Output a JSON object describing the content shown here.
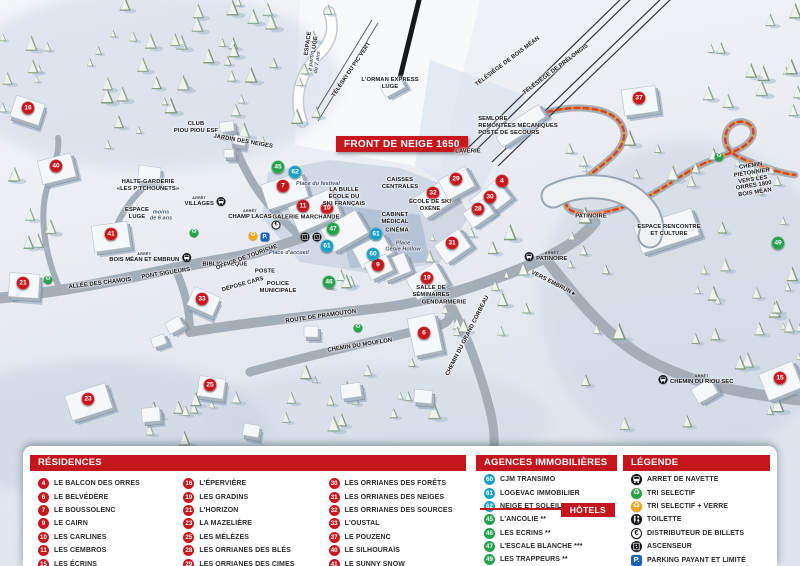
{
  "map": {
    "front_banner": "FRONT DE NEIGE 1650",
    "bus_stop_prefix": "ARRÊT",
    "markers": [
      [
        16,
        28,
        108,
        "residence"
      ],
      [
        40,
        56,
        166,
        "residence"
      ],
      [
        41,
        111,
        234,
        "residence"
      ],
      [
        21,
        23,
        283,
        "residence"
      ],
      [
        33,
        202,
        299,
        "residence"
      ],
      [
        23,
        88,
        399,
        "residence"
      ],
      [
        25,
        210,
        385,
        "residence"
      ],
      [
        7,
        283,
        186,
        "residence"
      ],
      [
        11,
        303,
        206,
        "residence"
      ],
      [
        10,
        327,
        208,
        "residence"
      ],
      [
        9,
        378,
        265,
        "residence"
      ],
      [
        32,
        433,
        193,
        "residence"
      ],
      [
        29,
        456,
        179,
        "residence"
      ],
      [
        4,
        502,
        181,
        "residence"
      ],
      [
        30,
        490,
        197,
        "residence"
      ],
      [
        28,
        478,
        209,
        "residence"
      ],
      [
        31,
        452,
        243,
        "residence"
      ],
      [
        19,
        427,
        278,
        "residence"
      ],
      [
        6,
        424,
        333,
        "residence"
      ],
      [
        37,
        639,
        98,
        "residence"
      ],
      [
        15,
        780,
        378,
        "residence"
      ],
      [
        45,
        278,
        167,
        "hotel"
      ],
      [
        47,
        333,
        229,
        "hotel"
      ],
      [
        46,
        329,
        282,
        "hotel"
      ],
      [
        49,
        778,
        243,
        "hotel"
      ],
      [
        62,
        295,
        172,
        "agency"
      ],
      [
        61,
        327,
        246,
        "agency"
      ],
      [
        61,
        376,
        234,
        "agency"
      ],
      [
        60,
        373,
        254,
        "agency"
      ]
    ],
    "labels": [
      {
        "t": "CLUB\nPIOU PIOU ESF",
        "x": 196,
        "y": 128
      },
      {
        "t": "JARDIN DES NEIGES",
        "x": 243,
        "y": 142,
        "r": 10
      },
      {
        "t": "ESPACE\nLUGE",
        "x": 312,
        "y": 44,
        "r": -82
      },
      {
        "t": "à partir\nde 7 ans",
        "x": 315,
        "y": 62,
        "r": -82,
        "c": "it"
      },
      {
        "t": "TÉLÉSKI DU PIC VERT",
        "x": 352,
        "y": 70,
        "r": -56
      },
      {
        "t": "L'ORMAN EXPRESS\nLUGE",
        "x": 390,
        "y": 84
      },
      {
        "t": "TÉLÉSIÈGE DE BOIS MÉAN",
        "x": 508,
        "y": 62,
        "r": -37
      },
      {
        "t": "TÉLÉSIÈGE DE PRÉLONGIS",
        "x": 556,
        "y": 70,
        "r": -37
      },
      {
        "t": "SEMLORE\nREMONTÉES MÉCANIQUES\nPOSTE DE SECOURS",
        "x": 518,
        "y": 126,
        "c": "lf"
      },
      {
        "t": "HALTE-GARDERIE\n«LES P'TCHOUNETS»",
        "x": 148,
        "y": 186
      },
      {
        "t": "ESPACE\nLUGE",
        "x": 137,
        "y": 214
      },
      {
        "t": "moins\nde 6 ans",
        "x": 161,
        "y": 216,
        "c": "it"
      },
      {
        "t": "Place du festival",
        "x": 318,
        "y": 184,
        "c": "it"
      },
      {
        "t": "LA BULLE\nÉCOLE DU\nSKI FRANÇAIS",
        "x": 344,
        "y": 197
      },
      {
        "t": "GALERIE MARCHANDE",
        "x": 306,
        "y": 218
      },
      {
        "t": "CAISSES\nCENTRALES",
        "x": 400,
        "y": 184
      },
      {
        "t": "ÉCOLE DE SKI\nOXÈNE",
        "x": 430,
        "y": 206
      },
      {
        "t": "CABINET\nMÉDICAL",
        "x": 395,
        "y": 219
      },
      {
        "t": "CINÉMA",
        "x": 397,
        "y": 231
      },
      {
        "t": "Place\nGénie Hollow",
        "x": 403,
        "y": 247,
        "c": "it"
      },
      {
        "t": "LAVERIE",
        "x": 468,
        "y": 152
      },
      {
        "t": "PATINOIRE",
        "x": 591,
        "y": 217
      },
      {
        "t": "ESPACE RENCONTRE\nET CULTURE",
        "x": 669,
        "y": 231
      },
      {
        "t": "CHEMIN PIÉTONNIER\nVERS LES ORRES 1800\nBOIS MÉAN",
        "x": 753,
        "y": 180,
        "r": -9
      },
      {
        "t": "PONT SIGUEURS",
        "x": 166,
        "y": 274,
        "r": -9
      },
      {
        "t": "ALLÉE DES CHAMOIS",
        "x": 100,
        "y": 284,
        "r": -7
      },
      {
        "t": "BIBLIOTHÈQUE",
        "x": 225,
        "y": 265
      },
      {
        "t": "OFFICE DE TOURISME",
        "x": 247,
        "y": 258,
        "r": -20
      },
      {
        "t": "POSTE",
        "x": 265,
        "y": 272
      },
      {
        "t": "DÉPOSE CARS",
        "x": 243,
        "y": 285,
        "r": -16
      },
      {
        "t": "POLICE\nMUNICIPALE",
        "x": 278,
        "y": 288
      },
      {
        "t": "Place d'accueil",
        "x": 289,
        "y": 253,
        "c": "it"
      },
      {
        "t": "ROUTE DE PRAMOUTON",
        "x": 321,
        "y": 317,
        "r": -8
      },
      {
        "t": "CHEMIN DU MOUFLON",
        "x": 360,
        "y": 346,
        "r": -9
      },
      {
        "t": "CHEMIN DU GRAND CORBEAU",
        "x": 468,
        "y": 336,
        "r": -63
      },
      {
        "t": "VERS EMBRUN ▸",
        "x": 553,
        "y": 284,
        "r": 27
      },
      {
        "t": "SALLE DE\nSÉMINAIRES",
        "x": 431,
        "y": 292
      },
      {
        "t": "GENDARMERIE",
        "x": 444,
        "y": 303
      }
    ],
    "bus_stops": [
      {
        "label": "VILLAGES",
        "x": 205,
        "y": 202,
        "icon": "right"
      },
      {
        "label": "CHAMP LACAS",
        "x": 250,
        "y": 215,
        "icon": "none"
      },
      {
        "label": "BOIS MÉAN ET EMBRUN",
        "x": 150,
        "y": 258,
        "icon": "right"
      },
      {
        "label": "PATINOIRE",
        "x": 546,
        "y": 257,
        "icon": "left"
      },
      {
        "label": "CHEMIN DU RIOU SEC",
        "x": 696,
        "y": 380,
        "icon": "left"
      }
    ],
    "icons": [
      {
        "type": "recycle-green",
        "x": 194,
        "y": 233
      },
      {
        "type": "recycle-green",
        "x": 48,
        "y": 280
      },
      {
        "type": "recycle-green",
        "x": 358,
        "y": 328
      },
      {
        "type": "recycle-green",
        "x": 719,
        "y": 157
      },
      {
        "type": "recycle-orange",
        "x": 253,
        "y": 236
      },
      {
        "type": "parking",
        "x": 265,
        "y": 237
      },
      {
        "type": "euro",
        "x": 276,
        "y": 225
      },
      {
        "type": "elevator",
        "x": 305,
        "y": 237
      },
      {
        "type": "elevator",
        "x": 317,
        "y": 237
      }
    ]
  },
  "legend": {
    "residences": {
      "title": "RÉSIDENCES",
      "items": [
        [
          "4",
          "LE BALCON DES ORRES"
        ],
        [
          "6",
          "LE BELVÉDÈRE"
        ],
        [
          "7",
          "LE BOUSSOLENC"
        ],
        [
          "9",
          "LE CAIRN"
        ],
        [
          "10",
          "LES CARLINES"
        ],
        [
          "11",
          "LES CEMBROS"
        ],
        [
          "15",
          "LES ÉCRINS"
        ],
        [
          "16",
          "L'ÉPERVIÈRE"
        ],
        [
          "19",
          "LES GRADINS"
        ],
        [
          "21",
          "L'HORIZON"
        ],
        [
          "23",
          "LA MAZELIÈRE"
        ],
        [
          "25",
          "LES MÉLÈZES"
        ],
        [
          "28",
          "LES ORRIANES DES BLÉS"
        ],
        [
          "29",
          "LES ORRIANES DES CIMES"
        ],
        [
          "30",
          "LES ORRIANES DES FORÊTS"
        ],
        [
          "31",
          "LES ORRIANES DES NEIGES"
        ],
        [
          "32",
          "LES ORRIANES DES SOURCES"
        ],
        [
          "33",
          "L'OUSTAL"
        ],
        [
          "37",
          "LE POUZENC"
        ],
        [
          "40",
          "LE SILHOURAÏS"
        ],
        [
          "41",
          "LE SUNNY SNOW"
        ]
      ]
    },
    "agencies": {
      "title": "AGENCES IMMOBILIÈRES",
      "items": [
        [
          "60",
          "CJM TRANSIMO"
        ],
        [
          "61",
          "LOGEVAC IMMOBILIER"
        ],
        [
          "62",
          "NEIGE ET SOLEIL"
        ]
      ]
    },
    "hotels": {
      "badge": "HÔTELS",
      "items": [
        [
          "45",
          "L'ANCOLIE **"
        ],
        [
          "46",
          "LES ECRINS **"
        ],
        [
          "47",
          "L'ESCALE BLANCHE ***"
        ],
        [
          "49",
          "LES TRAPPEURS **"
        ]
      ]
    },
    "legende": {
      "title": "LÉGENDE",
      "items": [
        [
          "bus",
          "ARRET DE NAVETTE"
        ],
        [
          "recycle-green",
          "TRI SELECTIF"
        ],
        [
          "recycle-orange",
          "TRI SELECTIF + VERRE"
        ],
        [
          "toilet",
          "TOILETTE"
        ],
        [
          "euro",
          "DISTRIBUTEUR DE BILLETS"
        ],
        [
          "elevator",
          "ASCENSEUR"
        ],
        [
          "parking",
          "PARKING PAYANT ET LIMITÉ"
        ]
      ]
    }
  },
  "colors": {
    "residence": "#c8161e",
    "hotel": "#23a24c",
    "agency": "#1ba0c4",
    "header_red": "#c5161d",
    "banner_red": "#c8161e",
    "parking_blue": "#1c63b7",
    "path_orange": "#f59a23"
  }
}
